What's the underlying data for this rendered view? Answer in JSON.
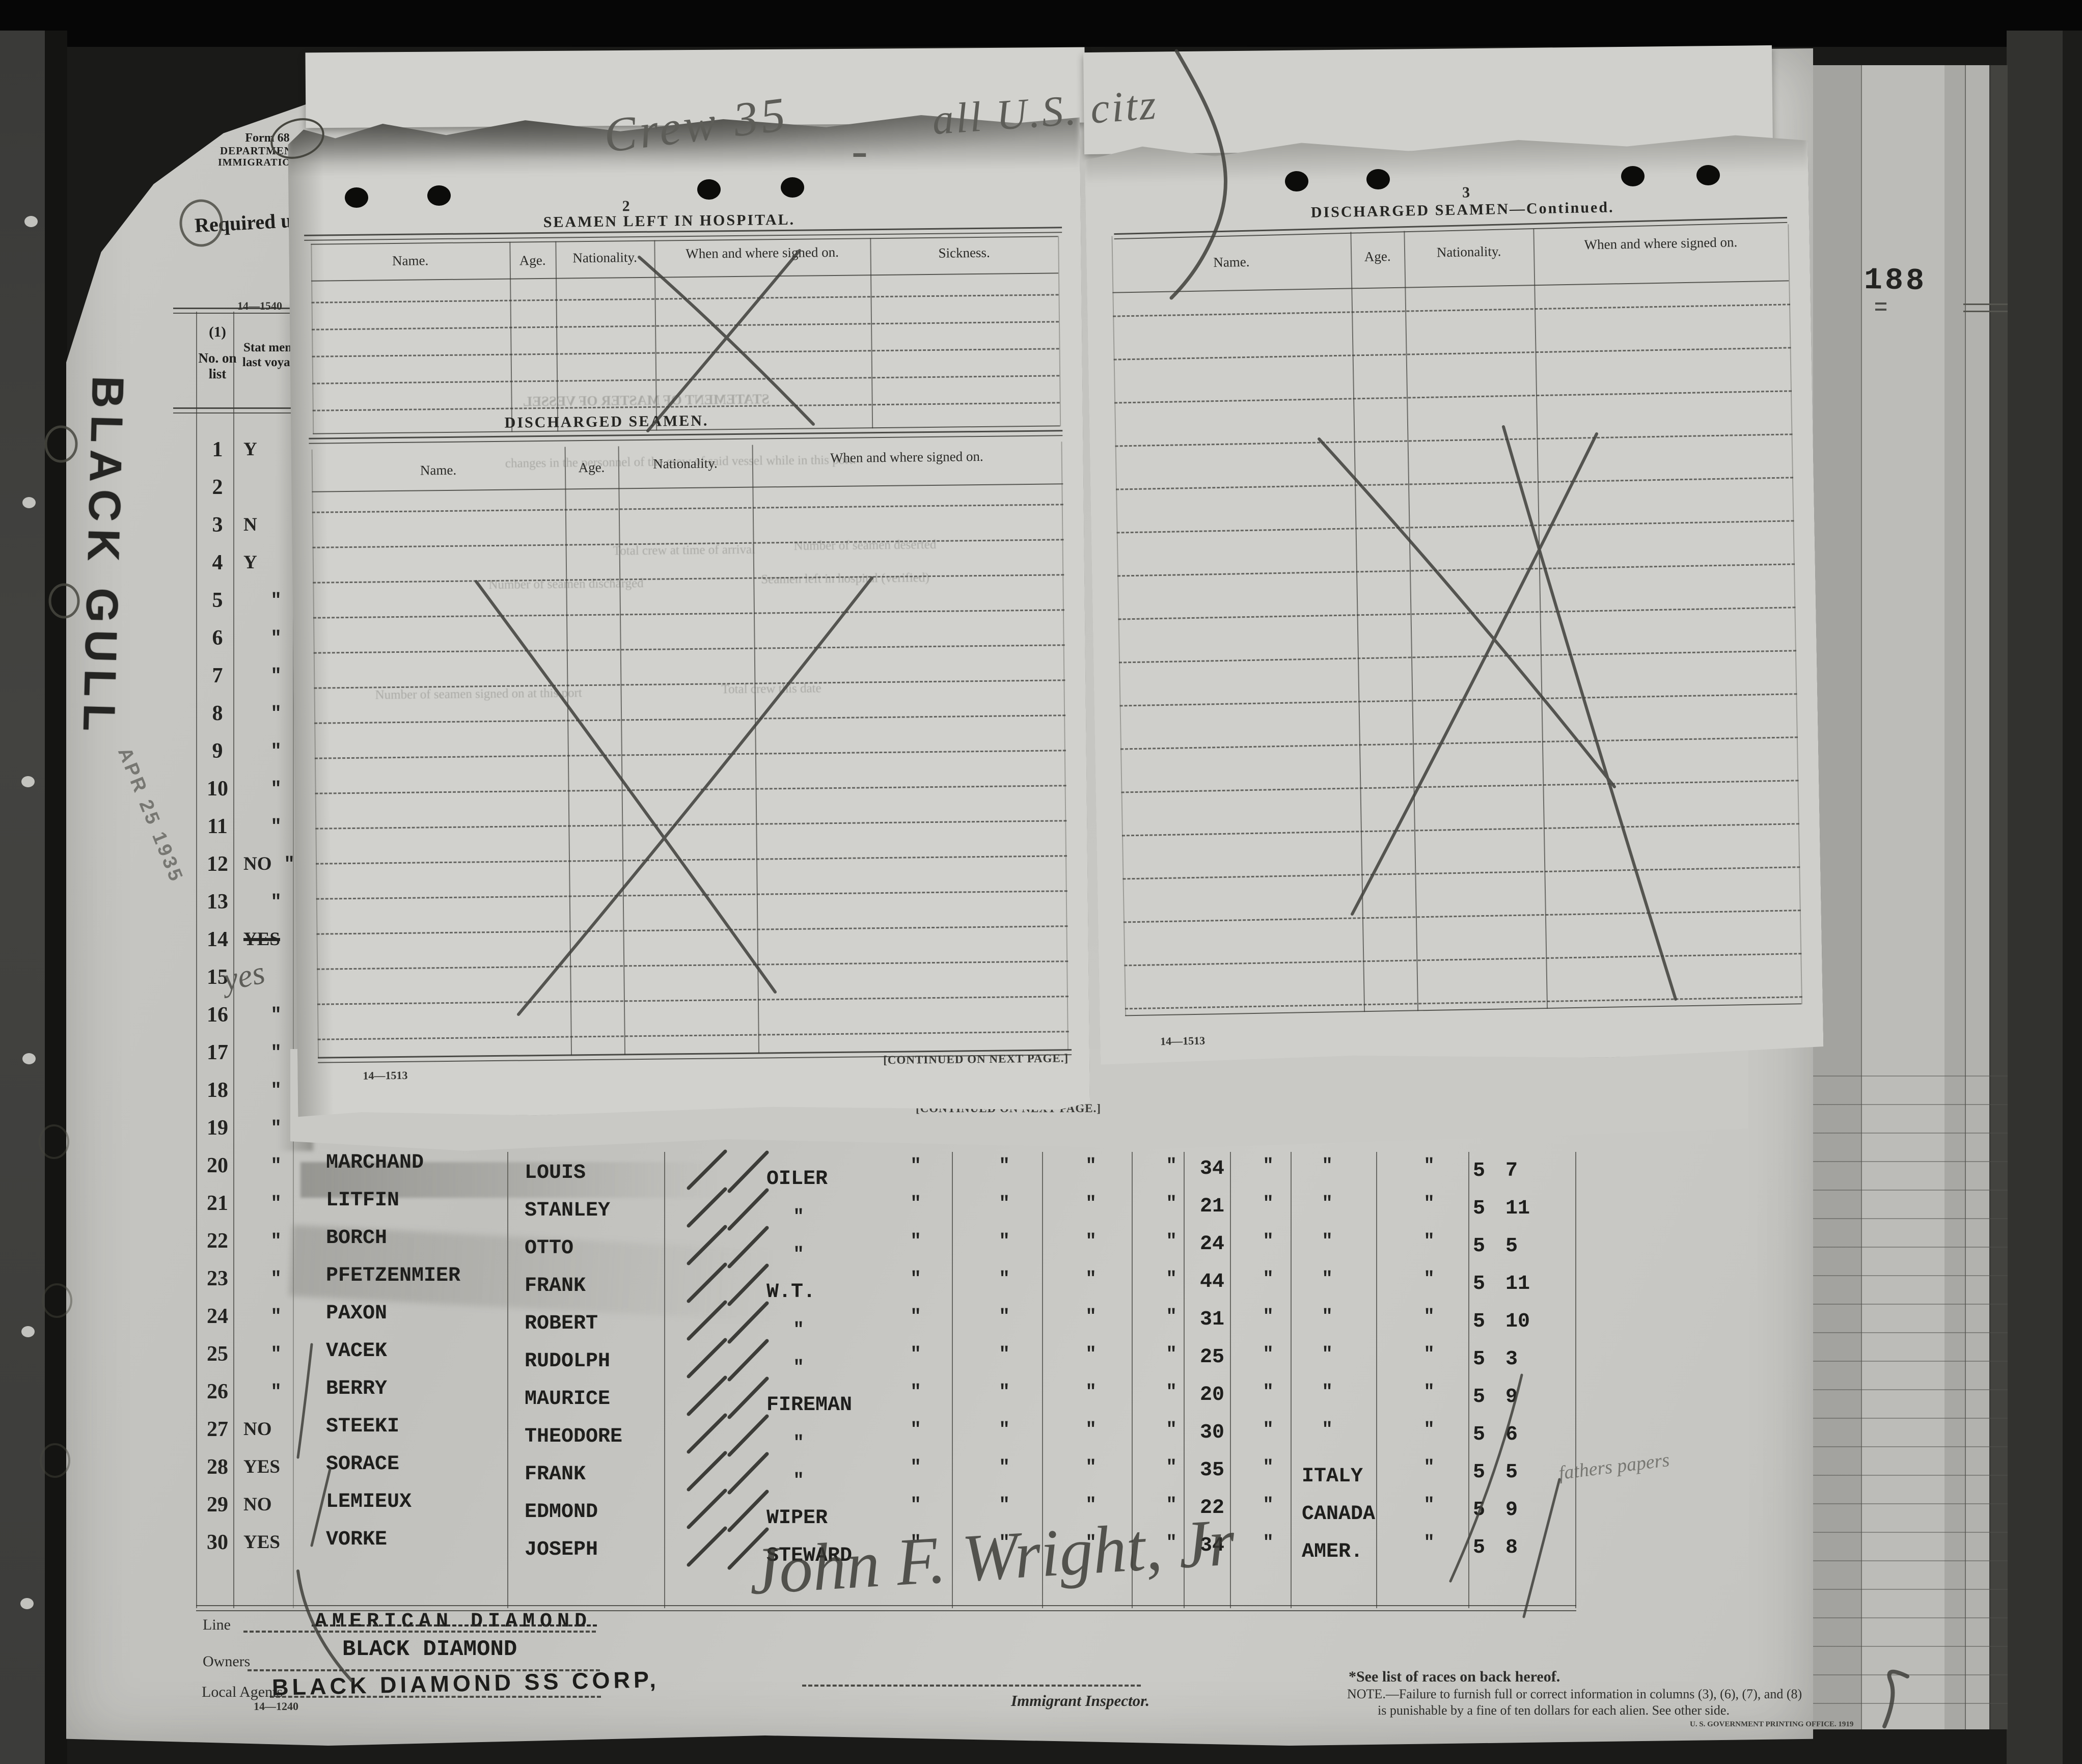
{
  "photo": {
    "page_stamp": "188"
  },
  "stamps": {
    "ship": "BLACK GULL",
    "date": "APR 25 1935"
  },
  "pencil": {
    "crew_note_left": "Crew 35",
    "crew_note_dash": "-",
    "crew_note_right": "all U.S. citz",
    "yes_hand": "yes",
    "note_row29": "fathers papers",
    "signature": "John F. Wright, Jr"
  },
  "form_header": {
    "form_no": "Form 68",
    "dept": "DEPARTMENT OF LABOR",
    "service": "IMMIGRATION SERVICE",
    "required": "Required u"
  },
  "hospital": {
    "page_no": "2",
    "title": "SEAMEN LEFT IN HOSPITAL.",
    "cols": {
      "name": "Name.",
      "age": "Age.",
      "nationality": "Nationality.",
      "signed": "When and where signed on.",
      "sickness": "Sickness."
    },
    "blank_rows": 5
  },
  "discharged": {
    "title": "DISCHARGED SEAMEN.",
    "cols": {
      "name": "Name.",
      "age": "Age.",
      "nationality": "Nationality.",
      "signed": "When and where signed on."
    },
    "blank_rows": 16,
    "form_no": "14—1513",
    "continued": "[CONTINUED ON NEXT PAGE.]"
  },
  "discharged_cont": {
    "page_no": "3",
    "title": "DISCHARGED SEAMEN—Continued.",
    "cols": {
      "name": "Name.",
      "age": "Age.",
      "nationality": "Nationality.",
      "signed": "When and where signed on."
    },
    "blank_rows": 17,
    "form_no": "14—1513"
  },
  "behind_sheet": {
    "continued": "[CONTINUED ON NEXT PAGE.]"
  },
  "crew_list": {
    "form_no_top": "14—1540",
    "header_num": "(1)",
    "header_no_on_list": "No. on list",
    "header_status": "Stat mem last voyag",
    "upper_rows": [
      {
        "n": "1",
        "s": "Y"
      },
      {
        "n": "2",
        "s": ""
      },
      {
        "n": "3",
        "s": "N"
      },
      {
        "n": "4",
        "s": "Y"
      },
      {
        "n": "5",
        "s": "\""
      },
      {
        "n": "6",
        "s": "\""
      },
      {
        "n": "7",
        "s": "\""
      },
      {
        "n": "8",
        "s": "\""
      },
      {
        "n": "9",
        "s": "\""
      },
      {
        "n": "10",
        "s": "\""
      },
      {
        "n": "11",
        "s": "\""
      },
      {
        "n": "12",
        "s": "NO",
        "d": "\""
      },
      {
        "n": "13",
        "s": "\""
      },
      {
        "n": "14",
        "s": "YES",
        "struck": true
      },
      {
        "n": "15",
        "s": ""
      },
      {
        "n": "16",
        "s": "\""
      },
      {
        "n": "17",
        "s": "\""
      },
      {
        "n": "18",
        "s": "\""
      },
      {
        "n": "19",
        "s": "\""
      }
    ],
    "rows": [
      {
        "n": "20",
        "s": "\"",
        "surname": "MARCHAND",
        "given": "LOUIS",
        "rating": "OILER",
        "dittos": [
          "\"",
          "\"",
          "\"",
          "\""
        ],
        "age": "34",
        "d5": "\"",
        "nat": "\"",
        "d6": "\"",
        "height": "5 7"
      },
      {
        "n": "21",
        "s": "\"",
        "surname": "LITFIN",
        "given": "STANLEY",
        "rating": "\"",
        "dittos": [
          "\"",
          "\"",
          "\"",
          "\""
        ],
        "age": "21",
        "d5": "\"",
        "nat": "\"",
        "d6": "\"",
        "height": "5 11"
      },
      {
        "n": "22",
        "s": "\"",
        "surname": "BORCH",
        "given": "OTTO",
        "rating": "\"",
        "dittos": [
          "\"",
          "\"",
          "\"",
          "\""
        ],
        "age": "24",
        "d5": "\"",
        "nat": "\"",
        "d6": "\"",
        "height": "5 5"
      },
      {
        "n": "23",
        "s": "\"",
        "surname": "PFETZENMIER",
        "given": "FRANK",
        "rating": "W.T.",
        "dittos": [
          "\"",
          "\"",
          "\"",
          "\""
        ],
        "age": "44",
        "d5": "\"",
        "nat": "\"",
        "d6": "\"",
        "height": "5 11"
      },
      {
        "n": "24",
        "s": "\"",
        "surname": "PAXON",
        "given": "ROBERT",
        "rating": "\"",
        "dittos": [
          "\"",
          "\"",
          "\"",
          "\""
        ],
        "age": "31",
        "d5": "\"",
        "nat": "\"",
        "d6": "\"",
        "height": "5 10"
      },
      {
        "n": "25",
        "s": "\"",
        "surname": "VACEK",
        "given": "RUDOLPH",
        "rating": "\"",
        "dittos": [
          "\"",
          "\"",
          "\"",
          "\""
        ],
        "age": "25",
        "d5": "\"",
        "nat": "\"",
        "d6": "\"",
        "height": "5 3"
      },
      {
        "n": "26",
        "s": "\"",
        "surname": "BERRY",
        "given": "MAURICE",
        "rating": "FIREMAN",
        "dittos": [
          "\"",
          "\"",
          "\"",
          "\""
        ],
        "age": "20",
        "d5": "\"",
        "nat": "\"",
        "d6": "\"",
        "height": "5 9"
      },
      {
        "n": "27",
        "s": "NO",
        "surname": "STEEKI",
        "given": "THEODORE",
        "rating": "\"",
        "dittos": [
          "\"",
          "\"",
          "\"",
          "\""
        ],
        "age": "30",
        "d5": "\"",
        "nat": "\"",
        "d6": "\"",
        "height": "5 6"
      },
      {
        "n": "28",
        "s": "YES",
        "surname": "SORACE",
        "given": "FRANK",
        "rating": "\"",
        "dittos": [
          "\"",
          "\"",
          "\"",
          "\""
        ],
        "age": "35",
        "d5": "\"",
        "nat": "ITALY",
        "d6": "\"",
        "height": "5 5"
      },
      {
        "n": "29",
        "s": "NO",
        "surname": "LEMIEUX",
        "given": "EDMOND",
        "rating": "WIPER",
        "dittos": [
          "\"",
          "\"",
          "\"",
          "\""
        ],
        "age": "22",
        "d5": "\"",
        "nat": "CANADA",
        "d6": "\"",
        "height": "5 9"
      },
      {
        "n": "30",
        "s": "YES",
        "surname": "VORKE",
        "given": "JOSEPH",
        "rating": "STEWARD",
        "dittos": [
          "\"",
          "\"",
          "\"",
          "\""
        ],
        "age": "34",
        "d5": "\"",
        "nat": "AMER.",
        "d6": "\"",
        "height": "5 8"
      }
    ],
    "bleed": {
      "statement": "STATEMENT OF MASTER OF VESSEL",
      "line1": "changes in the personnel of the crew of said vessel while in this port:",
      "line2a": "Total crew at time of arrival",
      "line2b": "Number of seamen deserted",
      "line3a": "Number of seamen discharged",
      "line3b": "Seamen left in hospital (verified)",
      "line4a": "Number of seamen signed on at this port",
      "line4b": "Total crew this date"
    }
  },
  "footer": {
    "line_label": "Line",
    "line_value": "AMERICAN DIAMOND",
    "owners_label": "Owners",
    "owners_value": "BLACK DIAMOND",
    "agents_label": "Local Agents",
    "agents_value": "BLACK DIAMOND SS CORP,",
    "form_no": "14—1240",
    "inspector": "Immigrant Inspector.",
    "note_races": "*See list of races on back hereof.",
    "note1": "NOTE.—Failure to furnish full or correct information in columns (3), (6), (7), and (8)",
    "note2": "is punishable by a fine of ten dollars for each alien.   See other side.",
    "gpo": "U. S. GOVERNMENT PRINTING OFFICE. 1919"
  }
}
